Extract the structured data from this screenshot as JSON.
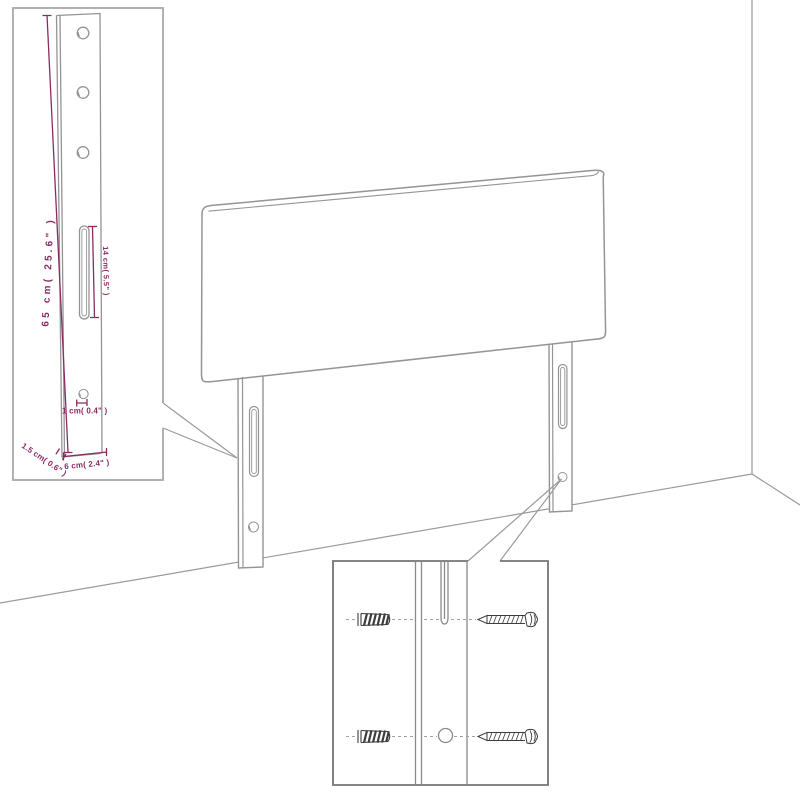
{
  "colors": {
    "dimension_accent": "#8b2a63",
    "drawing_outline": "#949494",
    "leg_callout_border": "#b0b0b0",
    "mounting_callout_border": "#757575",
    "hardware_ink": "#3d3d3d",
    "background": "#ffffff"
  },
  "main_view": {
    "subject": "upholstered headboard with two mounting legs standing against a wall corner"
  },
  "leg_detail": {
    "height_label": "65 cm( 25.6\" )",
    "slot_label": "14 cm( 5.5\" )",
    "hole_label": "1 cm( 0.4\" )",
    "thickness_label": "1.5 cm( 0.6\" )",
    "width_label": "6 cm( 2.4\" )"
  },
  "mounting_detail": {
    "hardware": [
      {
        "icon": "wall-plug-icon"
      },
      {
        "icon": "screw-icon"
      },
      {
        "icon": "wall-plug-icon"
      },
      {
        "icon": "screw-icon"
      }
    ]
  }
}
